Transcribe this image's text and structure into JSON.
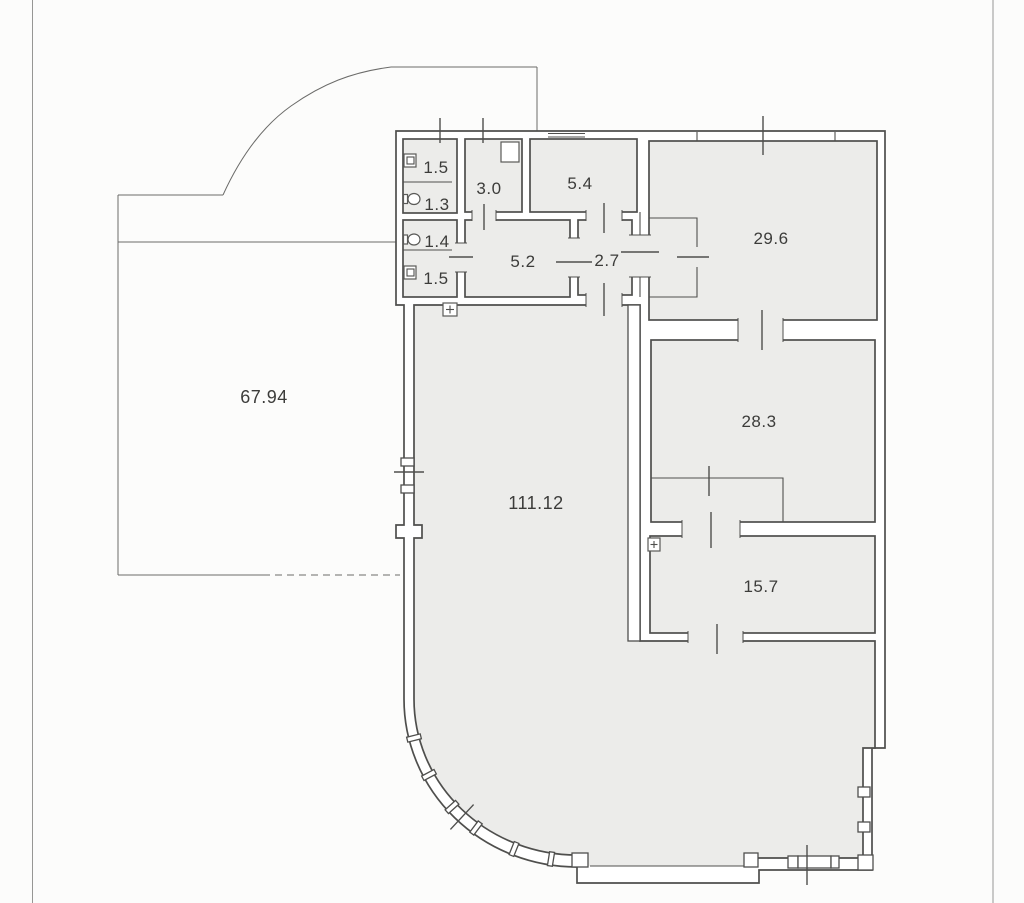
{
  "plan": {
    "type": "floor-plan",
    "rooms": [
      {
        "id": "wc-top",
        "area": "1.5"
      },
      {
        "id": "wc-1-3",
        "area": "1.3"
      },
      {
        "id": "wc-1-4",
        "area": "1.4"
      },
      {
        "id": "wc-bottom",
        "area": "1.5"
      },
      {
        "id": "room-3-0",
        "area": "3.0"
      },
      {
        "id": "room-5-4",
        "area": "5.4"
      },
      {
        "id": "room-5-2",
        "area": "5.2"
      },
      {
        "id": "hall-2-7",
        "area": "2.7"
      },
      {
        "id": "room-29-6",
        "area": "29.6"
      },
      {
        "id": "room-28-3",
        "area": "28.3"
      },
      {
        "id": "room-15-7",
        "area": "15.7"
      },
      {
        "id": "main-hall",
        "area": "111.12"
      },
      {
        "id": "terrace",
        "area": "67.94"
      }
    ],
    "fixtures": [
      "washbasin-icon",
      "toilet-icon",
      "toilet-icon",
      "washbasin-icon",
      "shaft-icon",
      "electric-panel-icon",
      "electric-panel-icon"
    ],
    "colors": {
      "paper": "#fcfcfb",
      "room_fill": "#ececea",
      "wall_line": "#4f4f4d",
      "label_text": "#3c3c3a",
      "scan_line": "#969694"
    }
  }
}
